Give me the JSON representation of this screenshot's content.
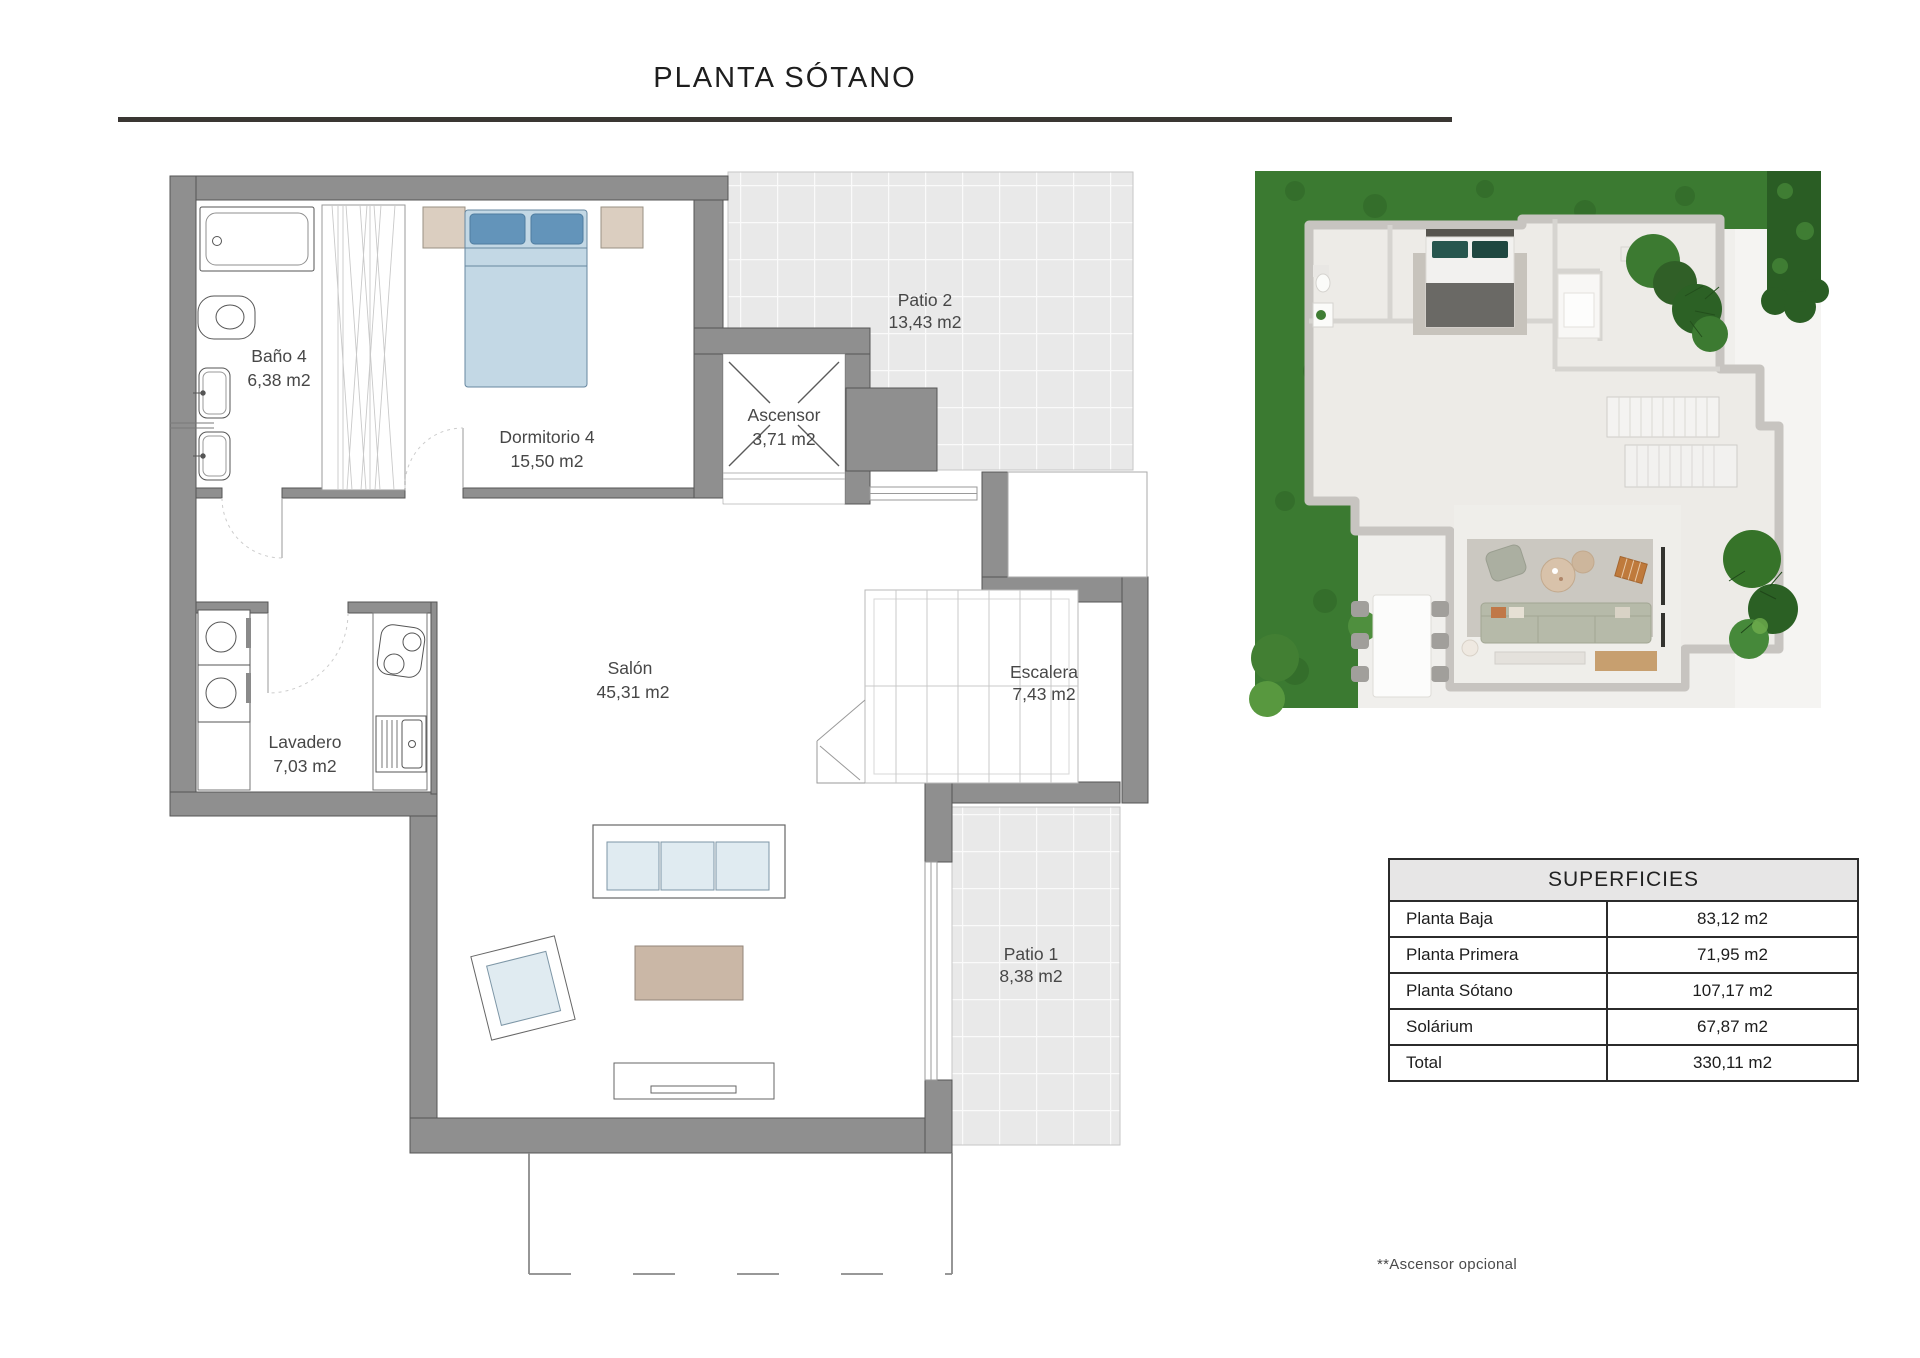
{
  "page": {
    "title": "PLANTA SÓTANO",
    "footnote": "**Ascensor opcional"
  },
  "floorplan": {
    "rooms": [
      {
        "id": "bano4",
        "name": "Baño 4",
        "area": "6,38 m2"
      },
      {
        "id": "dormitorio4",
        "name": "Dormitorio 4",
        "area": "15,50 m2"
      },
      {
        "id": "ascensor",
        "name": "Ascensor",
        "area": "3,71 m2"
      },
      {
        "id": "patio2",
        "name": "Patio 2",
        "area": "13,43 m2"
      },
      {
        "id": "salon",
        "name": "Salón",
        "area": "45,31 m2"
      },
      {
        "id": "escalera",
        "name": "Escalera",
        "area": "7,43 m2"
      },
      {
        "id": "lavadero",
        "name": "Lavadero",
        "area": "7,03 m2"
      },
      {
        "id": "patio1",
        "name": "Patio 1",
        "area": "8,38 m2"
      }
    ]
  },
  "table": {
    "title": "SUPERFICIES",
    "rows": [
      {
        "label": "Planta Baja",
        "value": "83,12 m2"
      },
      {
        "label": "Planta Primera",
        "value": "71,95 m2"
      },
      {
        "label": "Planta Sótano",
        "value": "107,17 m2"
      },
      {
        "label": "Solárium",
        "value": "67,87 m2"
      },
      {
        "label": "Total",
        "value": "330,11 m2"
      }
    ]
  },
  "colors": {
    "wall_gray": "#8f8f8f",
    "tile_gray": "#e9e9e9",
    "bed_blue": "#6394ba",
    "bed_light_blue": "#c3d8e5",
    "upholstery_blue": "#e0ebf1",
    "wood_beige": "#cab7a6",
    "nightstand_beige": "#dbcec0",
    "grass_green": "#3b7a31",
    "rule_dark": "#3a3633"
  }
}
